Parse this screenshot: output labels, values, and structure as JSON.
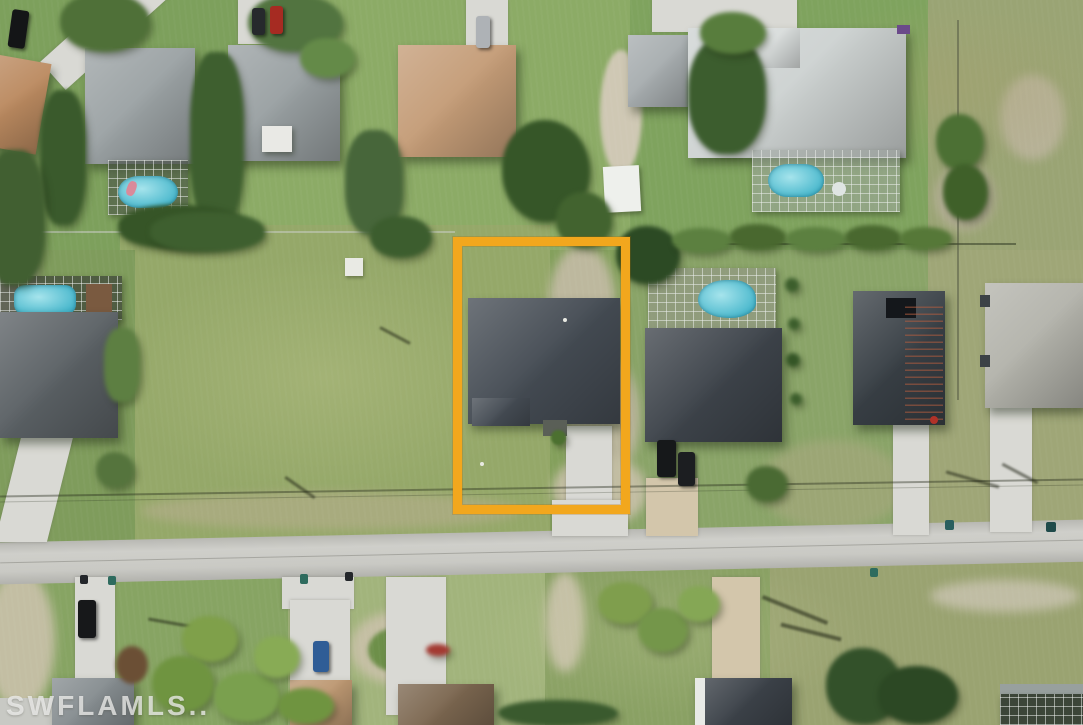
{
  "image": {
    "type": "aerial-drone-photo",
    "watermark": {
      "text": "SWFLAMLS.."
    },
    "highlight_box": {
      "color": "#F2A71D",
      "label": "outlined vacant-lot property boundary"
    },
    "palette": {
      "grass": "#84a05c",
      "dry_grass": "#9aa474",
      "road": "#c7c7c2",
      "concrete": "#d9d9d4",
      "sand": "#beb99d",
      "roof_charcoal": "#454c54",
      "roof_gray": "#9ba2a4",
      "roof_light": "#cdd2d1",
      "roof_tan": "#c49c77",
      "pool": "#54c2d3",
      "tree_dark": "#3a5a2c",
      "tree_light": "#6f9246"
    }
  }
}
